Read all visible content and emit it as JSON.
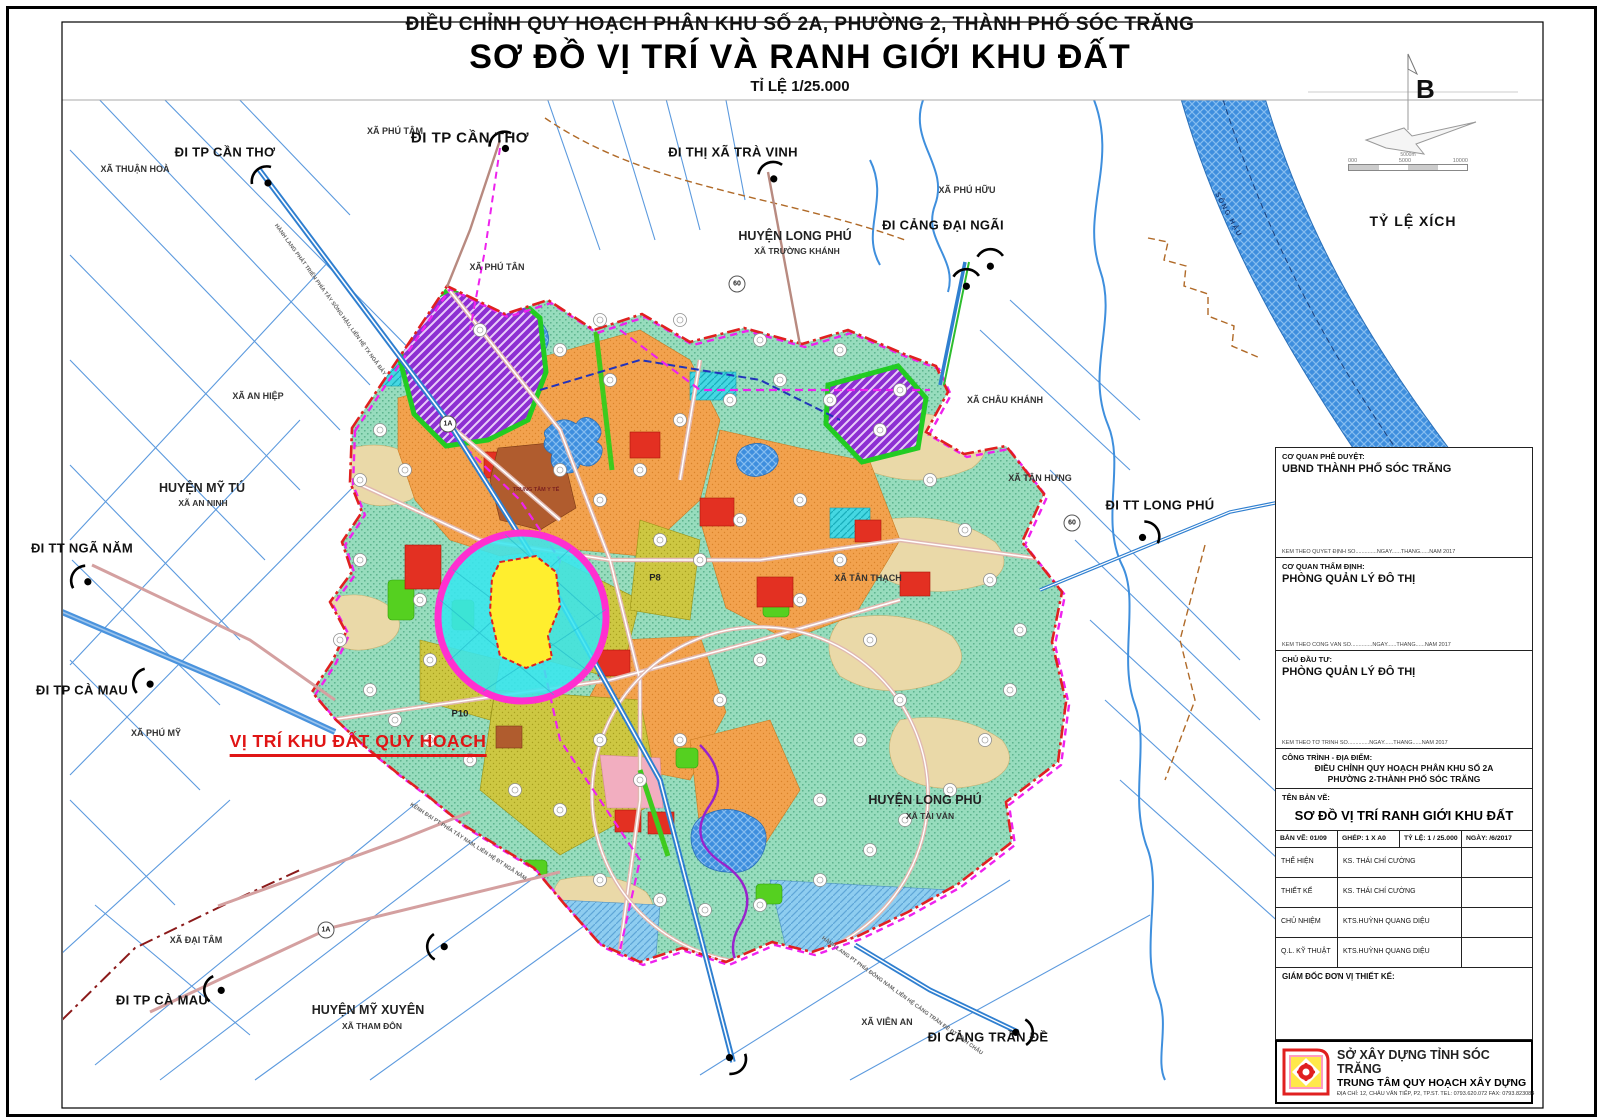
{
  "title": {
    "line1": "ĐIỀU CHỈNH QUY HOẠCH PHÂN KHU SỐ 2A, PHƯỜNG 2, THÀNH PHỐ SÓC TRĂNG",
    "line2": "SƠ ĐỒ VỊ TRÍ VÀ RANH GIỚI KHU ĐẤT",
    "line3": "TỈ LỆ 1/25.000"
  },
  "compass": {
    "north_letter": "B",
    "scale_caption": "TỶ LỆ XÍCH",
    "scale_above": "5000m",
    "ticks": [
      "000",
      "5000",
      "10000"
    ]
  },
  "map": {
    "labels": [
      {
        "id": "xa-thuan-hoa",
        "t": "XÃ THUẬN HOÀ",
        "x": 135,
        "y": 169,
        "k": "place"
      },
      {
        "id": "di-tp-can-tho-1",
        "t": "ĐI TP CẦN THƠ",
        "x": 225,
        "y": 152,
        "k": "route"
      },
      {
        "id": "xa-phu-tam",
        "t": "XÃ PHÚ TÂM",
        "x": 395,
        "y": 131,
        "k": "place"
      },
      {
        "id": "di-tp-can-tho-2",
        "t": "ĐI TP CẦN THƠ",
        "x": 470,
        "y": 138,
        "k": "route-lg"
      },
      {
        "id": "di-thi-xa-tra-vinh",
        "t": "ĐI THỊ XÃ TRÀ VINH",
        "x": 733,
        "y": 152,
        "k": "route"
      },
      {
        "id": "huyen-long-phu-1",
        "t": "HUYỆN LONG PHÚ",
        "x": 795,
        "y": 236,
        "k": "district"
      },
      {
        "id": "xa-truong-khanh",
        "t": "XÃ TRƯỜNG KHÁNH",
        "x": 797,
        "y": 251,
        "k": "sub"
      },
      {
        "id": "xa-phu-huu",
        "t": "XÃ PHÚ HỮU",
        "x": 967,
        "y": 190,
        "k": "place"
      },
      {
        "id": "di-cang-dai-ngai",
        "t": "ĐI CẢNG ĐẠI NGÃI",
        "x": 943,
        "y": 225,
        "k": "route"
      },
      {
        "id": "xa-phu-tan",
        "t": "XÃ PHÚ TÂN",
        "x": 497,
        "y": 267,
        "k": "place"
      },
      {
        "id": "xa-an-hiep",
        "t": "XÃ AN HIỆP",
        "x": 258,
        "y": 396,
        "k": "place"
      },
      {
        "id": "xa-chau-khanh",
        "t": "XÃ CHÂU KHÁNH",
        "x": 1005,
        "y": 400,
        "k": "place"
      },
      {
        "id": "xa-tan-hung",
        "t": "XÃ TÂN HƯNG",
        "x": 1040,
        "y": 478,
        "k": "place"
      },
      {
        "id": "huyen-my-tu",
        "t": "HUYỆN MỸ TÚ",
        "x": 202,
        "y": 488,
        "k": "district"
      },
      {
        "id": "xa-an-ninh",
        "t": "XÃ AN NINH",
        "x": 203,
        "y": 503,
        "k": "sub"
      },
      {
        "id": "di-tt-long-phu",
        "t": "ĐI TT LONG PHÚ",
        "x": 1160,
        "y": 505,
        "k": "route"
      },
      {
        "id": "di-tt-nga-nam",
        "t": "ĐI TT NGÃ NĂM",
        "x": 82,
        "y": 548,
        "k": "route"
      },
      {
        "id": "xa-tan-thach",
        "t": "XÃ TÂN THẠCH",
        "x": 868,
        "y": 578,
        "k": "place"
      },
      {
        "id": "di-tp-ca-mau-1",
        "t": "ĐI TP CÀ MAU",
        "x": 82,
        "y": 690,
        "k": "route"
      },
      {
        "id": "xa-phu-my",
        "t": "XÃ PHÚ MỸ",
        "x": 156,
        "y": 733,
        "k": "place"
      },
      {
        "id": "vi-tri-khu-dat",
        "t": "VỊ TRÍ KHU ĐẤT QUY HOẠCH",
        "x": 358,
        "y": 744,
        "k": "target"
      },
      {
        "id": "huyen-long-phu-2",
        "t": "HUYỆN LONG PHÚ",
        "x": 925,
        "y": 800,
        "k": "district"
      },
      {
        "id": "xa-tai-van",
        "t": "XÃ TÀI VĂN",
        "x": 930,
        "y": 816,
        "k": "sub"
      },
      {
        "id": "p8",
        "t": "P8",
        "x": 655,
        "y": 578,
        "k": "zone"
      },
      {
        "id": "p10",
        "t": "P10",
        "x": 460,
        "y": 714,
        "k": "zone"
      },
      {
        "id": "xa-dai-tam",
        "t": "XÃ ĐẠI TÂM",
        "x": 196,
        "y": 940,
        "k": "place"
      },
      {
        "id": "di-tp-ca-mau-2",
        "t": "ĐI TP CÀ MAU",
        "x": 162,
        "y": 1000,
        "k": "route"
      },
      {
        "id": "huyen-my-xuyen",
        "t": "HUYỆN MỸ XUYÊN",
        "x": 368,
        "y": 1010,
        "k": "district"
      },
      {
        "id": "xa-tham-don",
        "t": "XÃ THAM ĐÔN",
        "x": 372,
        "y": 1026,
        "k": "sub"
      },
      {
        "id": "xa-vien-an",
        "t": "XÃ VIÊN AN",
        "x": 887,
        "y": 1022,
        "k": "place"
      },
      {
        "id": "di-cang-tran-de",
        "t": "ĐI CẢNG TRẦN ĐỀ",
        "x": 988,
        "y": 1037,
        "k": "route"
      },
      {
        "id": "song-hau",
        "t": "SÔNG HẬU",
        "x": 1228,
        "y": 215,
        "k": "rivername",
        "rot": 62
      },
      {
        "id": "hanh-lang-tay",
        "t": "HÀNH LANG PHÁT TRIỂN PHÍA TÂY SÔNG HẬU, LIÊN HỆ TX NGÃ BẢY",
        "x": 330,
        "y": 300,
        "k": "roadname",
        "rot": 54
      },
      {
        "id": "kenh-dai-pt",
        "t": "KÊNH ĐẠI PT PHÍA TÂY NAM, LIÊN HỆ ĐT NGÃ NĂM",
        "x": 468,
        "y": 842,
        "k": "roadname",
        "rot": 33
      },
      {
        "id": "hanh-lang-dong-nam",
        "t": "HÀNH LANG PT PHÍA ĐÔNG NAM, LIÊN HỆ CẢNG TRẦN ĐỀ ĐT VĨNH CHÂU",
        "x": 902,
        "y": 996,
        "k": "roadname",
        "rot": 36
      },
      {
        "id": "trung-tam-y-te",
        "t": "TRUNG TÂM Y TẾ",
        "x": 536,
        "y": 490,
        "k": "ttyt"
      },
      {
        "id": "marker-1a-north",
        "t": "1A",
        "x": 448,
        "y": 424,
        "k": "circmark"
      },
      {
        "id": "marker-60-north",
        "t": "60",
        "x": 737,
        "y": 284,
        "k": "circmark"
      },
      {
        "id": "marker-60-east",
        "t": "60",
        "x": 1072,
        "y": 523,
        "k": "circmark"
      },
      {
        "id": "marker-1a-south",
        "t": "1A",
        "x": 326,
        "y": 930,
        "k": "circmark"
      }
    ],
    "direction_symbols": [
      {
        "x": 265,
        "y": 180,
        "rot": 0
      },
      {
        "x": 503,
        "y": 145,
        "rot": 10
      },
      {
        "x": 772,
        "y": 175,
        "rot": 20
      },
      {
        "x": 990,
        "y": 262,
        "rot": 40
      },
      {
        "x": 966,
        "y": 282,
        "rot": 40
      },
      {
        "x": 1146,
        "y": 535,
        "rot": 100
      },
      {
        "x": 84,
        "y": 580,
        "rot": -20
      },
      {
        "x": 146,
        "y": 683,
        "rot": -30
      },
      {
        "x": 217,
        "y": 990,
        "rot": -40
      },
      {
        "x": 440,
        "y": 947,
        "rot": -50
      },
      {
        "x": 1020,
        "y": 1032,
        "rot": 130
      },
      {
        "x": 733,
        "y": 1060,
        "rot": 170
      }
    ],
    "parcel_markers": [
      [
        380,
        430
      ],
      [
        360,
        480
      ],
      [
        405,
        470
      ],
      [
        360,
        560
      ],
      [
        340,
        640
      ],
      [
        370,
        690
      ],
      [
        420,
        600
      ],
      [
        430,
        660
      ],
      [
        395,
        720
      ],
      [
        430,
        740
      ],
      [
        470,
        760
      ],
      [
        515,
        790
      ],
      [
        560,
        810
      ],
      [
        600,
        880
      ],
      [
        660,
        900
      ],
      [
        705,
        910
      ],
      [
        760,
        905
      ],
      [
        820,
        880
      ],
      [
        870,
        850
      ],
      [
        905,
        820
      ],
      [
        950,
        790
      ],
      [
        985,
        740
      ],
      [
        1010,
        690
      ],
      [
        1020,
        630
      ],
      [
        990,
        580
      ],
      [
        965,
        530
      ],
      [
        930,
        480
      ],
      [
        880,
        430
      ],
      [
        830,
        400
      ],
      [
        780,
        380
      ],
      [
        730,
        400
      ],
      [
        680,
        420
      ],
      [
        640,
        470
      ],
      [
        600,
        500
      ],
      [
        560,
        470
      ],
      [
        660,
        540
      ],
      [
        700,
        560
      ],
      [
        740,
        520
      ],
      [
        800,
        500
      ],
      [
        840,
        560
      ],
      [
        800,
        600
      ],
      [
        760,
        660
      ],
      [
        720,
        700
      ],
      [
        680,
        740
      ],
      [
        640,
        780
      ],
      [
        600,
        740
      ],
      [
        870,
        640
      ],
      [
        900,
        700
      ],
      [
        860,
        740
      ],
      [
        820,
        800
      ],
      [
        560,
        350
      ],
      [
        610,
        380
      ],
      [
        480,
        330
      ],
      [
        600,
        320
      ],
      [
        680,
        320
      ],
      [
        760,
        340
      ],
      [
        840,
        350
      ],
      [
        900,
        390
      ]
    ]
  },
  "titleblock": {
    "s1_label": "CƠ QUAN PHÊ DUYỆT:",
    "s1_value": "UBND THÀNH PHỐ SÓC TRĂNG",
    "s1_note": "KÈM THEO QUYẾT ĐỊNH SỐ..............NGÀY......THÁNG......NĂM 2017",
    "s2_label": "CƠ QUAN THẨM ĐỊNH:",
    "s2_value": "PHÒNG QUẢN LÝ ĐÔ THỊ",
    "s2_note": "KÈM THEO CÔNG VĂN SỐ..............NGÀY......THÁNG......NĂM 2017",
    "s3_label": "CHỦ ĐẦU TƯ:",
    "s3_value": "PHÒNG QUẢN LÝ ĐÔ THỊ",
    "s3_note": "KÈM THEO TỜ TRÌNH SỐ..............NGÀY......THÁNG......NĂM 2017",
    "s4_label": "CÔNG TRÌNH - ĐỊA ĐIỂM:",
    "s4_line1": "ĐIỀU CHỈNH QUY HOẠCH PHÂN KHU SỐ 2A",
    "s4_line2": "PHƯỜNG 2-THÀNH PHỐ SÓC TRĂNG",
    "s5_label": "TÊN BẢN VẼ:",
    "s5_value": "SƠ ĐỒ VỊ TRÍ RANH GIỚI KHU ĐẤT",
    "meta": {
      "ban_ve": "BẢN VẼ: 01/09",
      "ghep": "GHÉP: 1 X A0",
      "ty_le": "TỶ LỆ: 1 / 25.000",
      "ngay": "NGÀY: /6/2017"
    },
    "staff": [
      {
        "role": "THỂ HIỆN",
        "name": "KS. THÁI CHÍ CƯỜNG"
      },
      {
        "role": "THIẾT KẾ",
        "name": "KS. THÁI CHÍ CƯỜNG"
      },
      {
        "role": "CHỦ NHIỆM",
        "name": "KTS.HUỲNH QUANG DIỆU"
      },
      {
        "role": "Q.L. KỸ THUẬT",
        "name": "KTS.HUỲNH QUANG DIỆU"
      }
    ],
    "director_label": "GIÁM ĐỐC ĐƠN VỊ THIẾT KẾ:"
  },
  "logo": {
    "org1": "SỞ XÂY DỰNG TỈNH SÓC TRĂNG",
    "org2": "TRUNG TÂM QUY HOẠCH XÂY DỰNG",
    "address": "ĐỊA CHỈ: 12, CHÂU VĂN TIẾP, P2, TP.ST. TEL: 0793.620.072  FAX: 0793.823084"
  }
}
